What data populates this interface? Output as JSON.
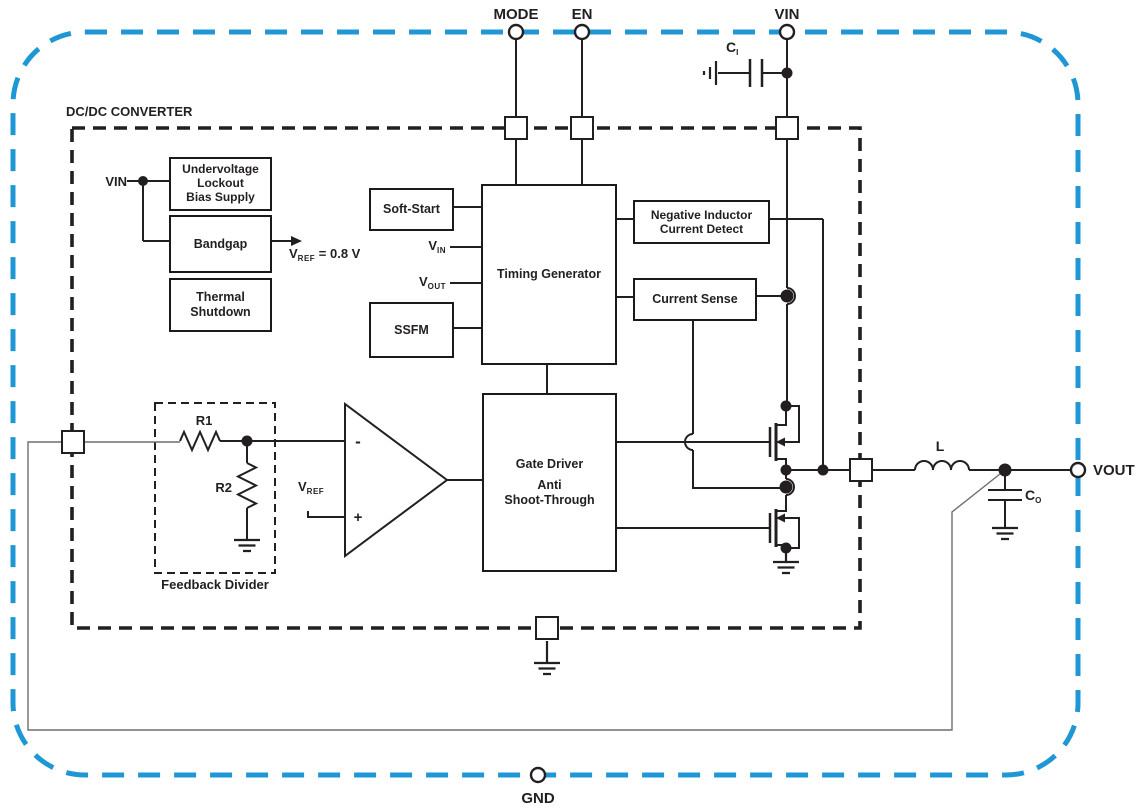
{
  "colors": {
    "boundary_blue": "#1f97d4",
    "wire_black": "#231f20",
    "wire_gray": "#6e6e6e"
  },
  "pins": {
    "mode": "MODE",
    "en": "EN",
    "vin": "VIN",
    "vout": "VOUT",
    "gnd": "GND"
  },
  "chip": {
    "title": "DC/DC CONVERTER"
  },
  "blocks": {
    "uvlo": {
      "line1": "Undervoltage",
      "line2": "Lockout",
      "line3": "Bias Supply"
    },
    "bandgap": {
      "label": "Bandgap"
    },
    "thermal": {
      "line1": "Thermal",
      "line2": "Shutdown"
    },
    "soft_start": {
      "label": "Soft-Start"
    },
    "ssfm": {
      "label": "SSFM"
    },
    "timing": {
      "label": "Timing Generator"
    },
    "nicd": {
      "line1": "Negative Inductor",
      "line2": "Current Detect"
    },
    "current_sense": {
      "label": "Current Sense"
    },
    "gate_driver": {
      "line1": "Gate Driver",
      "line2": "Anti",
      "line3": "Shoot-Through"
    }
  },
  "labels": {
    "vin_internal": "VIN",
    "vref_value": {
      "main": "V",
      "sub": "REF",
      "rest": " = 0.8 V"
    },
    "vin_input": {
      "main": "V",
      "sub": "IN"
    },
    "vout_input": {
      "main": "V",
      "sub": "OUT"
    },
    "vref_opamp": {
      "main": "V",
      "sub": "REF"
    },
    "opamp_minus": "-",
    "opamp_plus": "+",
    "r1": "R1",
    "r2": "R2",
    "feedback_divider": "Feedback Divider",
    "inductor": "L",
    "cap_in": {
      "main": "C",
      "sub": "I"
    },
    "cap_out": {
      "main": "C",
      "sub": "O"
    }
  }
}
